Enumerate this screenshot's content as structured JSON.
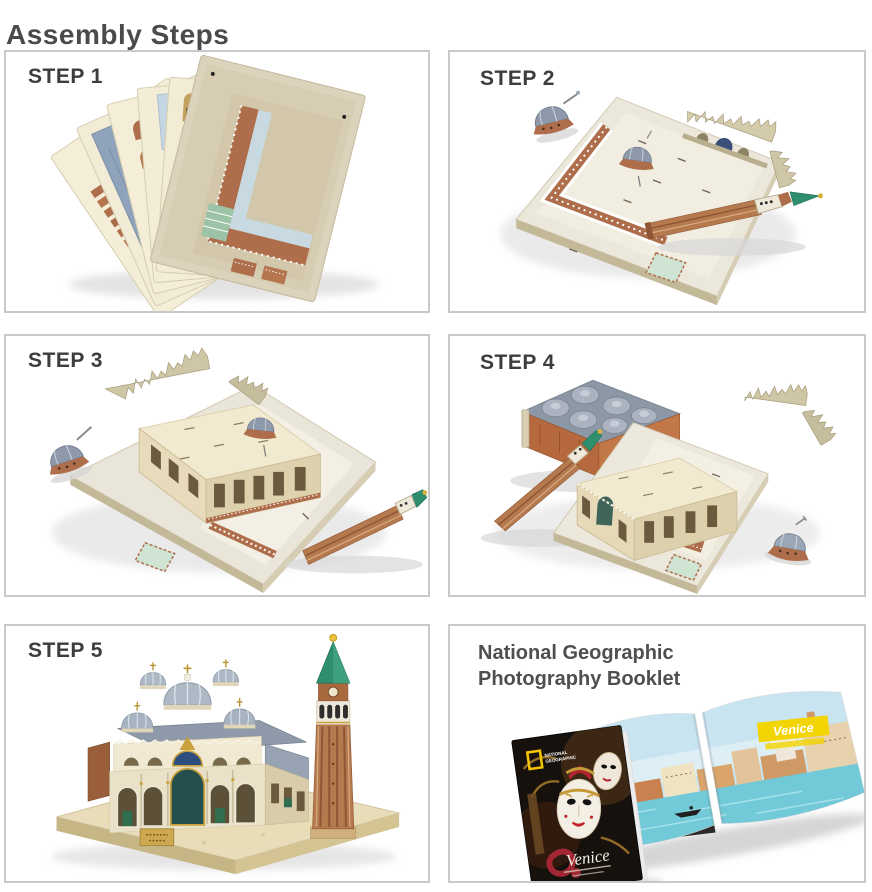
{
  "page": {
    "title": "Assembly Steps"
  },
  "steps": [
    {
      "label": "STEP 1",
      "photo": "fan of six printed punch-out cardboard sheets"
    },
    {
      "label": "STEP 2",
      "photo": "piazza base board with loose dome, basilica facade strip and campanile lying on it"
    },
    {
      "label": "STEP 3",
      "photo": "basilica walls assembled on base board; domes, gothic crest strip and campanile still loose"
    },
    {
      "label": "STEP 4",
      "photo": "domed roof piece, gothic crest strip, dome and campanile arranged around basilica on base board"
    },
    {
      "label": "STEP 5",
      "photo": "completed St. Mark's Square model with domed basilica and campanile tower"
    }
  ],
  "booklet": {
    "heading_line1": "National Geographic",
    "heading_line2": "Photography Booklet",
    "logo_line1": "NATIONAL",
    "logo_line2": "GEOGRAPHIC",
    "cover_title": "Venice",
    "spread_title": "Venice"
  },
  "colors": {
    "panel_border": "#c9c9c9",
    "title_text": "#4a4a4a",
    "step_label_text": "#3d3d3d",
    "brick": "#ae6e4b",
    "board_cream": "#ebe7da",
    "dome_blue_gray": "#9aa7b6",
    "spire_green": "#2f8e6e",
    "ng_yellow": "#f5c400",
    "water_teal": "#72c9d8"
  }
}
